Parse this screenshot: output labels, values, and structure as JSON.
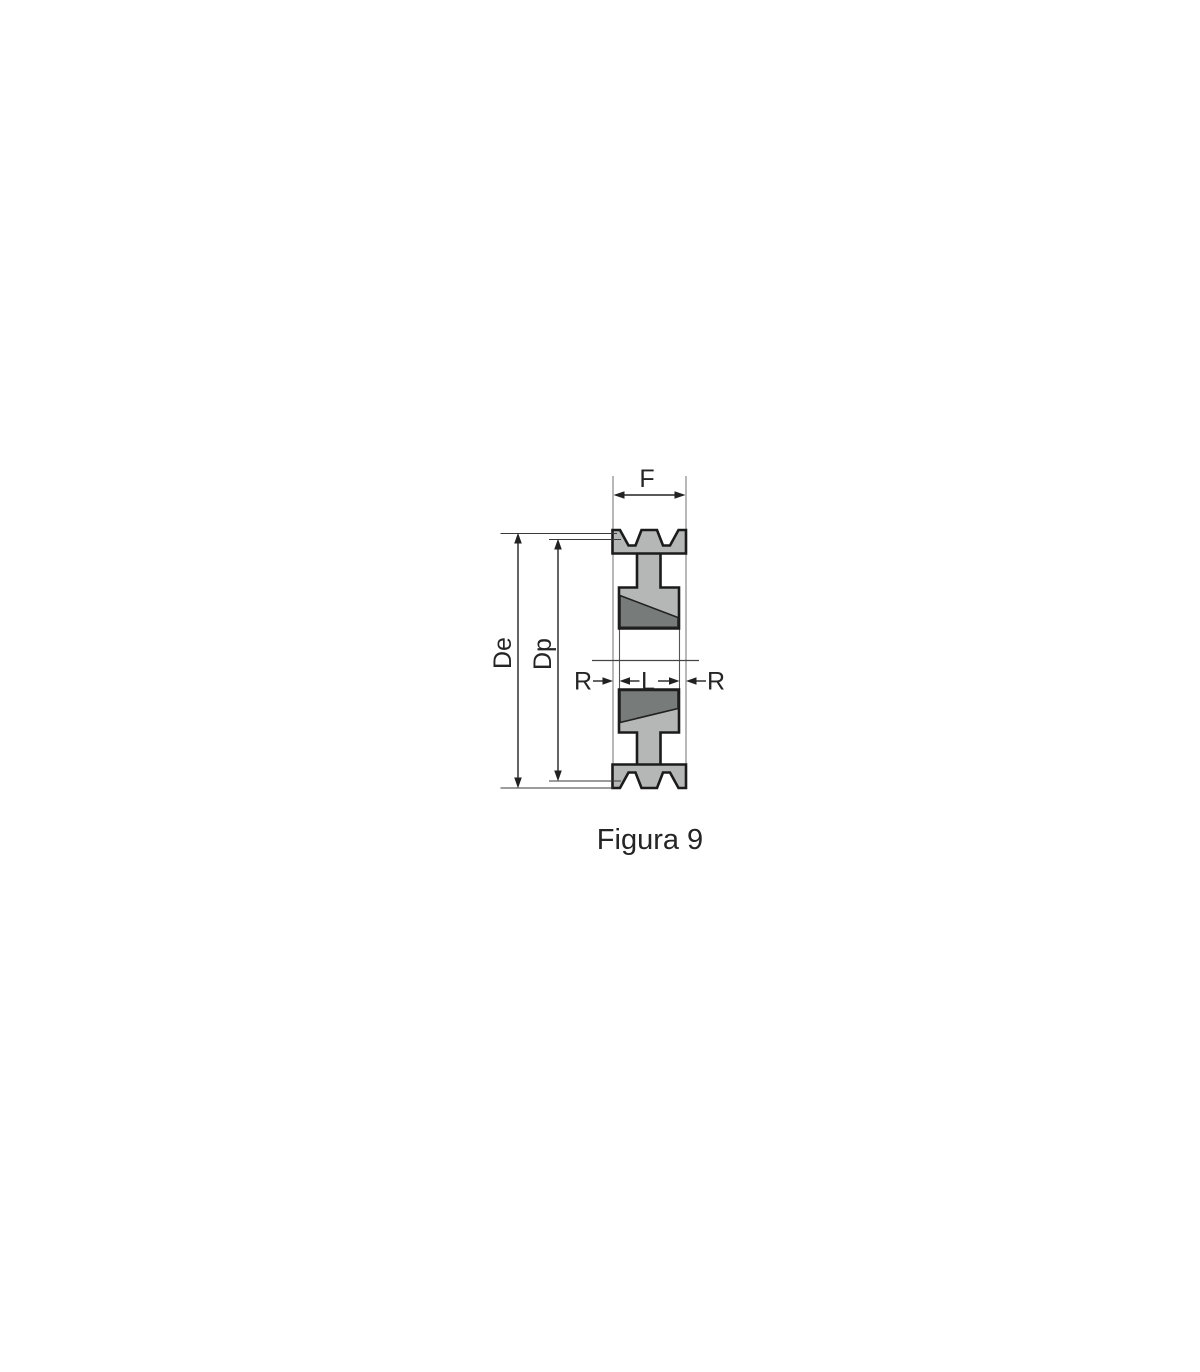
{
  "figure": {
    "caption": "Figura 9",
    "labels": {
      "face_width": "F",
      "outer_diameter": "De",
      "pitch_diameter": "Dp",
      "recess_left": "R",
      "bush_length": "L",
      "recess_right": "R"
    },
    "colors": {
      "pulley_body_fill": "#b5b7b6",
      "taper_bush_fill": "#777b7a",
      "outline": "#1b1b1b",
      "dimension_lines": "#222222",
      "thin_extension_line": "#9a9a9a",
      "background": "#ffffff"
    }
  }
}
